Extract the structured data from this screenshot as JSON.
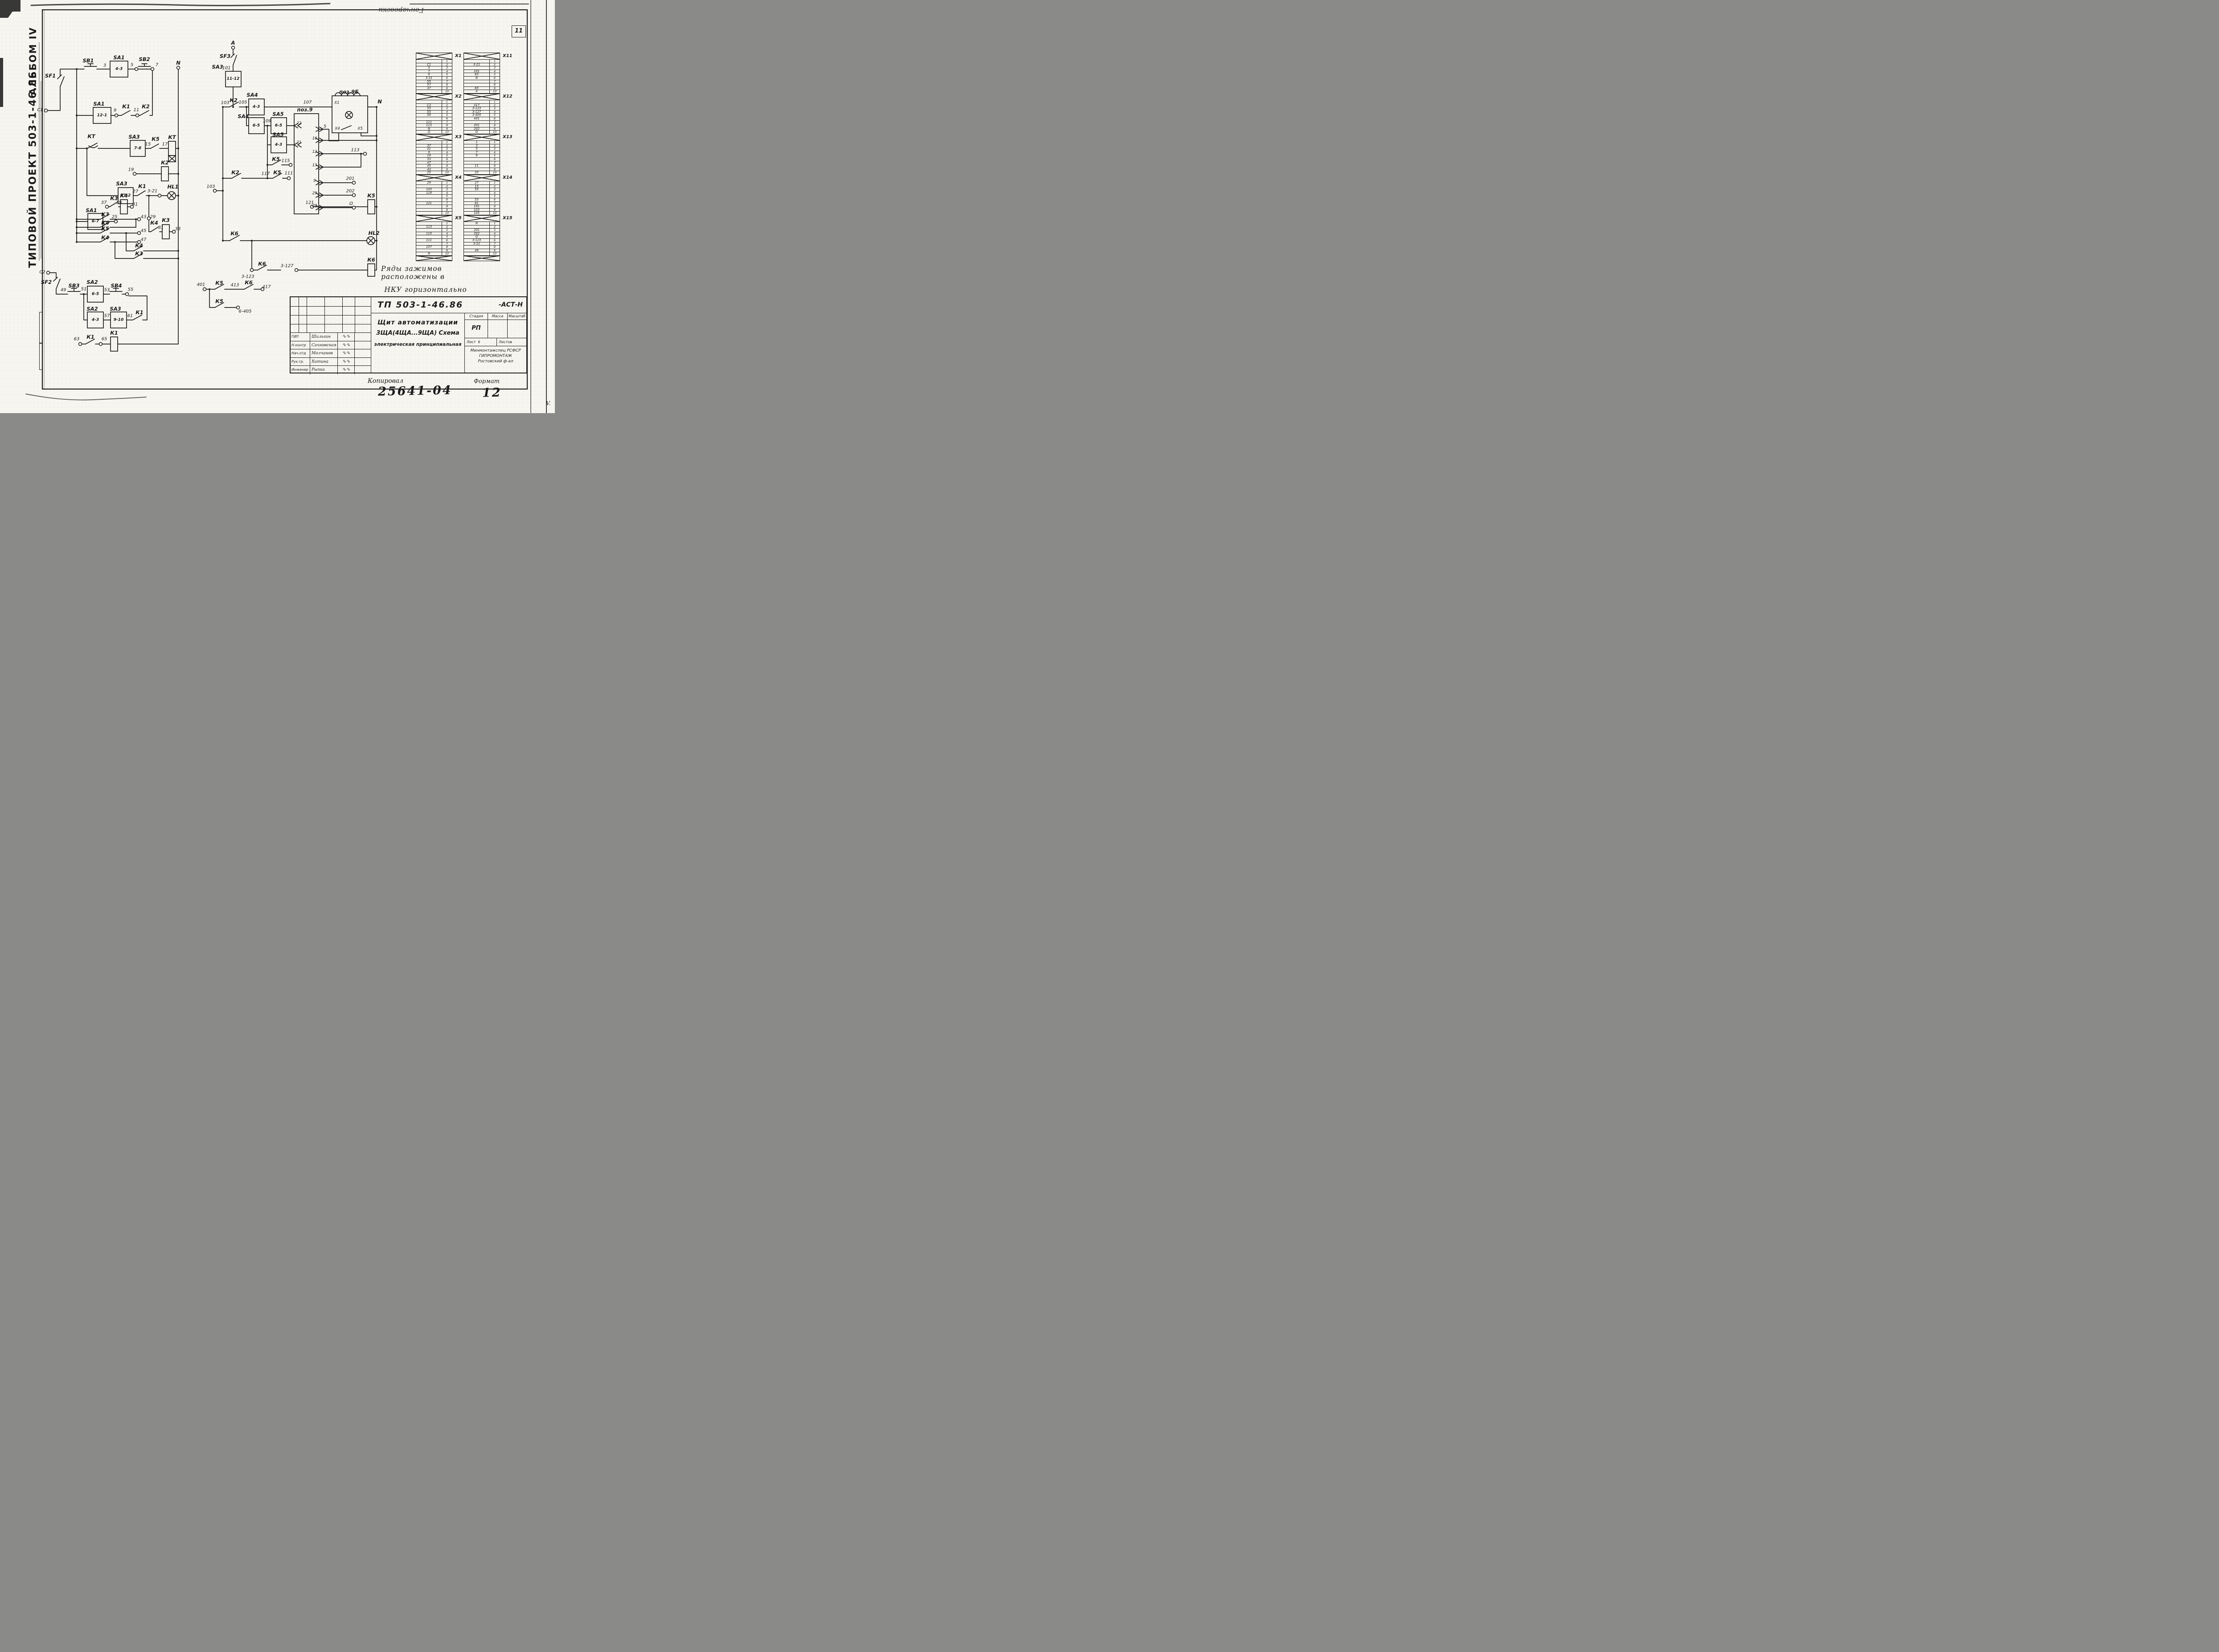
{
  "page": {
    "number": "11",
    "handwriting_top": "Гончаровски",
    "copied_label": "Копировал",
    "format_label": "Формат",
    "stamp_number": "25641-04",
    "stamp_sheet": "12",
    "corner_mark": "V."
  },
  "sidebar": {
    "album": "АЛЬБОМ IV",
    "project": "ТИПОВОЙ ПРОЕКТ 503-1-46.86"
  },
  "note": {
    "line1": "Ряды зажимов расположены в",
    "line2": "НКУ   горизонтально"
  },
  "titleblock": {
    "doc": "ТП 503-1-46.86",
    "doc_suffix": "-АСТ-Н",
    "title_line1": "Щит автоматизации",
    "title_line2": "3ЩА(4ЩА...9ЩА) Схема",
    "title_line3": "электрическая принципиальная",
    "stage_label": "Стадия",
    "mass_label": "Масса",
    "scale_label": "Масштаб",
    "stage_value": "РП",
    "sheet_label": "Лист",
    "sheet_value": "6",
    "sheets_label": "Листов",
    "org_line1": "Минмонтажспец РСФСР",
    "org_line2": "ГИПРОМОНТАЖ",
    "org_line3": "Ростовский ф-ал",
    "signature_mark": "∿∿",
    "signers": [
      {
        "role": "ГИП",
        "name": "Шильгин"
      },
      {
        "role": "Н.контр",
        "name": "Сахновская"
      },
      {
        "role": "Нач.отд",
        "name": "Молчанов"
      },
      {
        "role": "Рук.гр.",
        "name": "Хитина"
      },
      {
        "role": "Инженер",
        "name": "Рыпка"
      }
    ]
  },
  "schematic": {
    "labels": [
      [
        "SF1",
        113,
        170,
        "c"
      ],
      [
        "SB1",
        198,
        136,
        "c"
      ],
      [
        "SA1",
        267,
        129,
        "c"
      ],
      [
        "4-3",
        267,
        155,
        "b"
      ],
      [
        "3",
        235,
        147,
        "w"
      ],
      [
        "5",
        296,
        146,
        "w"
      ],
      [
        "SB2",
        324,
        133,
        "c"
      ],
      [
        "7",
        352,
        146,
        "w"
      ],
      [
        "N",
        400,
        141,
        "c"
      ],
      [
        "C1",
        90,
        247,
        "w"
      ],
      [
        "SA1",
        222,
        233,
        "c"
      ],
      [
        "12-1",
        229,
        259,
        "b"
      ],
      [
        "9",
        258,
        248,
        "w"
      ],
      [
        "К1",
        283,
        239,
        "c"
      ],
      [
        "11",
        306,
        247,
        "w"
      ],
      [
        "К2",
        327,
        239,
        "c"
      ],
      [
        "КТ",
        205,
        306,
        "c"
      ],
      [
        "SA3",
        301,
        307,
        "c"
      ],
      [
        "7-8",
        309,
        333,
        "b"
      ],
      [
        "15",
        332,
        324,
        "w"
      ],
      [
        "К5",
        349,
        312,
        "c"
      ],
      [
        "17",
        370,
        324,
        "w"
      ],
      [
        "КТ",
        386,
        308,
        "c"
      ],
      [
        "19",
        294,
        381,
        "w"
      ],
      [
        "К2",
        370,
        365,
        "c"
      ],
      [
        "SA3",
        273,
        412,
        "c"
      ],
      [
        "11-2",
        282,
        439,
        "b"
      ],
      [
        "27",
        304,
        430,
        "w"
      ],
      [
        "К1",
        319,
        418,
        "c"
      ],
      [
        "3-21",
        342,
        429,
        "w"
      ],
      [
        "HL1",
        388,
        419,
        "c"
      ],
      [
        "SA1",
        205,
        472,
        "c"
      ],
      [
        "6-7",
        214,
        497,
        "b"
      ],
      [
        "25",
        257,
        487,
        "w"
      ],
      [
        "29",
        343,
        487,
        "w"
      ],
      [
        "К4",
        346,
        500,
        "c"
      ],
      [
        "31",
        361,
        511,
        "w"
      ],
      [
        "К3",
        372,
        494,
        "c"
      ],
      [
        "33",
        399,
        514,
        "w"
      ],
      [
        "37",
        233,
        455,
        "w"
      ],
      [
        "К3",
        256,
        445,
        "c"
      ],
      [
        "39",
        267,
        455,
        "w"
      ],
      [
        "К4",
        278,
        439,
        "c"
      ],
      [
        "41",
        303,
        459,
        "w"
      ],
      [
        "К3",
        236,
        481,
        "c"
      ],
      [
        "43",
        322,
        487,
        "w"
      ],
      [
        "К4",
        236,
        500,
        "c"
      ],
      [
        "К5",
        236,
        513,
        "c"
      ],
      [
        "45",
        322,
        518,
        "w"
      ],
      [
        "К4",
        236,
        533,
        "c"
      ],
      [
        "47",
        322,
        538,
        "w"
      ],
      [
        "К4",
        312,
        551,
        "c"
      ],
      [
        "К3",
        312,
        569,
        "c"
      ],
      [
        "C2",
        95,
        611,
        "w"
      ],
      [
        "SF2",
        104,
        633,
        "c"
      ],
      [
        "49",
        142,
        651,
        "w"
      ],
      [
        "SB3",
        166,
        641,
        "c"
      ],
      [
        "51",
        188,
        649,
        "w"
      ],
      [
        "SA2",
        207,
        633,
        "c"
      ],
      [
        "6-5",
        214,
        660,
        "b"
      ],
      [
        "53",
        240,
        651,
        "w"
      ],
      [
        "SB4",
        261,
        641,
        "c"
      ],
      [
        "55",
        293,
        650,
        "w"
      ],
      [
        "SA2",
        207,
        693,
        "c"
      ],
      [
        "4-3",
        214,
        718,
        "b"
      ],
      [
        "57",
        240,
        709,
        "w"
      ],
      [
        "SA3",
        259,
        693,
        "c"
      ],
      [
        "9-10",
        266,
        718,
        "b"
      ],
      [
        "61",
        292,
        709,
        "w"
      ],
      [
        "К1",
        313,
        701,
        "c"
      ],
      [
        "63",
        172,
        761,
        "w"
      ],
      [
        "К1",
        203,
        756,
        "c"
      ],
      [
        "65",
        234,
        761,
        "w"
      ],
      [
        "К1",
        256,
        747,
        "c"
      ],
      [
        "A",
        523,
        96,
        "c"
      ],
      [
        "SF3",
        505,
        126,
        "c"
      ],
      [
        "101",
        508,
        153,
        "w"
      ],
      [
        "SA3",
        488,
        150,
        "c"
      ],
      [
        "11-12",
        523,
        177,
        "b"
      ],
      [
        "103",
        505,
        231,
        "w"
      ],
      [
        "К2",
        524,
        225,
        "c"
      ],
      [
        "105",
        545,
        230,
        "w"
      ],
      [
        "SA4",
        566,
        213,
        "c"
      ],
      [
        "4-3",
        575,
        240,
        "b"
      ],
      [
        "107",
        690,
        230,
        "w"
      ],
      [
        "N",
        852,
        228,
        "c"
      ],
      [
        "поз.9Б",
        783,
        206,
        "c"
      ],
      [
        "Х1",
        756,
        231,
        "p"
      ],
      [
        "Х4",
        757,
        289,
        "p"
      ],
      [
        "Х5",
        808,
        289,
        "p"
      ],
      [
        "5",
        729,
        284,
        "w"
      ],
      [
        "SA4",
        546,
        261,
        "c"
      ],
      [
        "6-5",
        575,
        282,
        "b"
      ],
      [
        "109",
        599,
        272,
        "w"
      ],
      [
        "SA5",
        624,
        256,
        "c"
      ],
      [
        "6-5",
        625,
        282,
        "b"
      ],
      [
        "SA5",
        624,
        302,
        "c"
      ],
      [
        "4-3",
        625,
        325,
        "b"
      ],
      [
        "поз.9",
        684,
        246,
        "c"
      ],
      [
        "22",
        671,
        277,
        "p"
      ],
      [
        "21",
        671,
        320,
        "p"
      ],
      [
        "16",
        706,
        311,
        "p"
      ],
      [
        "12",
        706,
        341,
        "p"
      ],
      [
        "13",
        706,
        371,
        "p"
      ],
      [
        "9",
        706,
        406,
        "p"
      ],
      [
        "29",
        706,
        434,
        "p"
      ],
      [
        "20",
        706,
        462,
        "p"
      ],
      [
        "113",
        797,
        337,
        "w"
      ],
      [
        "201",
        786,
        401,
        "w"
      ],
      [
        "202",
        786,
        429,
        "w"
      ],
      [
        "Ω",
        788,
        457,
        "w"
      ],
      [
        "К5",
        619,
        357,
        "c"
      ],
      [
        "115",
        641,
        361,
        "w"
      ],
      [
        "К2",
        528,
        387,
        "c"
      ],
      [
        "117",
        596,
        390,
        "w"
      ],
      [
        "К5",
        622,
        387,
        "c"
      ],
      [
        "111",
        648,
        389,
        "w"
      ],
      [
        "103",
        473,
        419,
        "w"
      ],
      [
        "121",
        695,
        455,
        "w"
      ],
      [
        "К5",
        833,
        439,
        "c"
      ],
      [
        "К6",
        526,
        524,
        "c"
      ],
      [
        "HL2",
        839,
        523,
        "c"
      ],
      [
        "3-123",
        556,
        621,
        "w"
      ],
      [
        "К6",
        588,
        592,
        "c"
      ],
      [
        "3-127",
        644,
        597,
        "w"
      ],
      [
        "К6",
        833,
        583,
        "c"
      ],
      [
        "401",
        451,
        639,
        "w"
      ],
      [
        "К5",
        492,
        635,
        "c"
      ],
      [
        "413",
        527,
        640,
        "w"
      ],
      [
        "К6",
        558,
        634,
        "c"
      ],
      [
        "417",
        598,
        644,
        "w"
      ],
      [
        "К5",
        492,
        676,
        "c"
      ],
      [
        "6-405",
        550,
        699,
        "w"
      ]
    ]
  },
  "terminals": {
    "left": [
      {
        "name": "Х1",
        "rows": [
          [
            "",
            "1"
          ],
          [
            "C1",
            "2"
          ],
          [
            "5",
            "3"
          ],
          [
            "7",
            "4"
          ],
          [
            "9",
            "5"
          ],
          [
            "3-21",
            "6"
          ],
          [
            "55",
            "7"
          ],
          [
            "57",
            "8"
          ],
          [
            "37",
            "9"
          ],
          [
            "",
            "10"
          ]
        ]
      },
      {
        "name": "Х2",
        "rows": [
          [
            "",
            "1"
          ],
          [
            "C2",
            "2"
          ],
          [
            "53",
            "3"
          ],
          [
            "55",
            "4"
          ],
          [
            "59",
            "5"
          ],
          [
            "",
            "6"
          ],
          [
            "111",
            "7"
          ],
          [
            "113",
            "8"
          ],
          [
            "N",
            "9"
          ],
          [
            "Ω",
            "10"
          ]
        ]
      },
      {
        "name": "Х3",
        "rows": [
          [
            "",
            "1"
          ],
          [
            "37",
            "2"
          ],
          [
            "41",
            "3"
          ],
          [
            "9",
            "4"
          ],
          [
            "19",
            "5"
          ],
          [
            "33",
            "6"
          ],
          [
            "47",
            "7"
          ],
          [
            "45",
            "8"
          ],
          [
            "43",
            "9"
          ],
          [
            "25",
            "10"
          ]
        ]
      },
      {
        "name": "Х4",
        "rows": [
          [
            "29",
            "1"
          ],
          [
            "",
            "2"
          ],
          [
            "103",
            "3"
          ],
          [
            "119",
            "4"
          ],
          [
            "",
            "5"
          ],
          [
            "",
            "6"
          ],
          [
            "121",
            "7"
          ],
          [
            "",
            "8"
          ],
          [
            "",
            "9"
          ],
          [
            "",
            "10"
          ]
        ]
      },
      {
        "name": "Х5",
        "rows": [
          [
            "",
            "1"
          ],
          [
            "113",
            "2"
          ],
          [
            "",
            "3"
          ],
          [
            "115",
            "4"
          ],
          [
            "",
            "5"
          ],
          [
            "111",
            "6"
          ],
          [
            "",
            "7"
          ],
          [
            "107",
            "8"
          ],
          [
            "",
            "9"
          ],
          [
            "N",
            "10"
          ]
        ]
      }
    ],
    "right": [
      {
        "name": "Х11",
        "rows": [
          [
            "",
            "1"
          ],
          [
            "3-21",
            "2"
          ],
          [
            "",
            "3"
          ],
          [
            "101",
            "4"
          ],
          [
            "63",
            "5"
          ],
          [
            "N",
            "6"
          ],
          [
            "",
            "7"
          ],
          [
            "",
            "8"
          ],
          [
            "65",
            "9"
          ],
          [
            "A",
            "10"
          ]
        ]
      },
      {
        "name": "Х12",
        "rows": [
          [
            "",
            "1"
          ],
          [
            "417",
            "2"
          ],
          [
            "3-123",
            "3"
          ],
          [
            "3-127",
            "4"
          ],
          [
            "3-405",
            "5"
          ],
          [
            "401",
            "6"
          ],
          [
            "",
            "7"
          ],
          [
            "201",
            "8"
          ],
          [
            "202",
            "9"
          ],
          [
            "Ω",
            "10"
          ]
        ]
      },
      {
        "name": "Х13",
        "rows": [
          [
            "1",
            "1"
          ],
          [
            "3",
            "2"
          ],
          [
            "5",
            "3"
          ],
          [
            "7",
            "4"
          ],
          [
            "9",
            "5"
          ],
          [
            "",
            "6"
          ],
          [
            "",
            "7"
          ],
          [
            "11",
            "8"
          ],
          [
            "",
            "9"
          ],
          [
            "25",
            "10"
          ]
        ]
      },
      {
        "name": "Х14",
        "rows": [
          [
            "27",
            "1"
          ],
          [
            "15",
            "2"
          ],
          [
            "55",
            "3"
          ],
          [
            "",
            "4"
          ],
          [
            "",
            "5"
          ],
          [
            "53",
            "6"
          ],
          [
            "61",
            "7"
          ],
          [
            "101",
            "8"
          ],
          [
            "103",
            "9"
          ],
          [
            "105",
            "10"
          ]
        ]
      },
      {
        "name": "Х15",
        "rows": [
          [
            "N",
            "1"
          ],
          [
            "",
            "2"
          ],
          [
            "201",
            "3"
          ],
          [
            "202",
            "4"
          ],
          [
            "Ω",
            "5"
          ],
          [
            "3-123",
            "6"
          ],
          [
            "3-21",
            "7"
          ],
          [
            "",
            "8"
          ],
          [
            "49",
            "9"
          ],
          [
            "",
            "10"
          ]
        ]
      }
    ]
  }
}
